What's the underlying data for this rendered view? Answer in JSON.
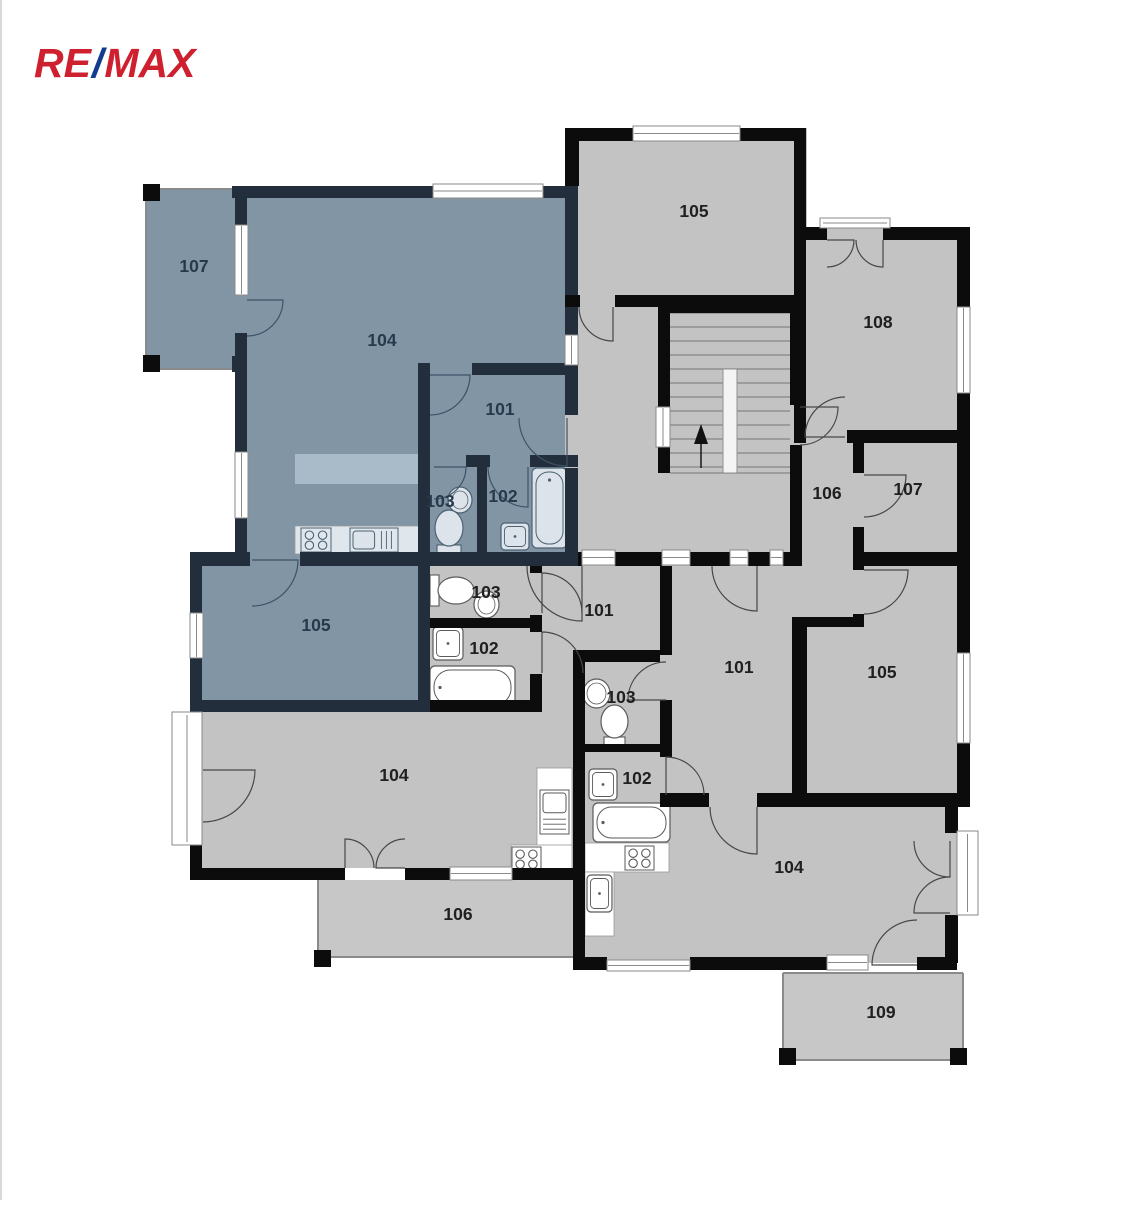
{
  "logo": {
    "re": "RE",
    "slash": "/",
    "max": "MAX",
    "red": "#cf2030",
    "blue": "#123d8f"
  },
  "palette": {
    "bg": "#ffffff",
    "room_gray": "#c3c3c3",
    "terrace_gray": "#c7c7c7",
    "room_blue": "#8195a5",
    "island_blue": "#a9bac8",
    "wall_black": "#0c0c0c",
    "wall_navy": "#222e3c",
    "label_black": "#202020",
    "label_navy": "#27394b",
    "door_black": "#474747",
    "door_navy": "#3e5368",
    "window_stroke": "#8a8a8a",
    "fixture_white": "#ffffff",
    "fixture_blue_fill": "#dce3ea",
    "fixture_blue_stroke": "#4c6172",
    "fixture_gray_stroke": "#5a5a5a",
    "stair_line": "#8f8f8f"
  },
  "floor_plan": {
    "room_labels": [
      {
        "t": "107",
        "x": 194,
        "y": 266,
        "z": "n"
      },
      {
        "t": "104",
        "x": 382,
        "y": 340,
        "z": "n"
      },
      {
        "t": "101",
        "x": 500,
        "y": 409,
        "z": "n"
      },
      {
        "t": "103",
        "x": 440,
        "y": 501,
        "z": "n"
      },
      {
        "t": "102",
        "x": 503,
        "y": 496,
        "z": "n"
      },
      {
        "t": "105",
        "x": 316,
        "y": 625,
        "z": "n"
      },
      {
        "t": "105",
        "x": 694,
        "y": 211,
        "z": "k"
      },
      {
        "t": "108",
        "x": 878,
        "y": 322,
        "z": "k"
      },
      {
        "t": "106",
        "x": 827,
        "y": 493,
        "z": "k"
      },
      {
        "t": "107",
        "x": 908,
        "y": 489,
        "z": "k"
      },
      {
        "t": "101",
        "x": 599,
        "y": 610,
        "z": "k"
      },
      {
        "t": "103",
        "x": 486,
        "y": 592,
        "z": "k"
      },
      {
        "t": "102",
        "x": 484,
        "y": 648,
        "z": "k"
      },
      {
        "t": "101",
        "x": 739,
        "y": 667,
        "z": "k"
      },
      {
        "t": "103",
        "x": 621,
        "y": 697,
        "z": "k"
      },
      {
        "t": "102",
        "x": 637,
        "y": 778,
        "z": "k"
      },
      {
        "t": "105",
        "x": 882,
        "y": 672,
        "z": "k"
      },
      {
        "t": "104",
        "x": 394,
        "y": 775,
        "z": "k"
      },
      {
        "t": "104",
        "x": 789,
        "y": 867,
        "z": "k"
      },
      {
        "t": "106",
        "x": 458,
        "y": 914,
        "z": "k"
      },
      {
        "t": "109",
        "x": 881,
        "y": 1012,
        "z": "k"
      }
    ],
    "fills": [
      [
        145,
        188,
        97,
        182,
        "b"
      ],
      [
        242,
        192,
        336,
        368,
        "b"
      ],
      [
        190,
        557,
        240,
        155,
        "b"
      ],
      [
        565,
        128,
        242,
        424,
        "g"
      ],
      [
        790,
        227,
        167,
        340,
        "g"
      ],
      [
        573,
        552,
        384,
        411,
        "g"
      ],
      [
        418,
        552,
        160,
        160,
        "g"
      ],
      [
        202,
        712,
        376,
        156,
        "g"
      ],
      [
        542,
        566,
        124,
        90,
        "g"
      ],
      [
        318,
        880,
        255,
        77,
        "t"
      ],
      [
        783,
        973,
        180,
        88,
        "t"
      ]
    ],
    "walls": [
      [
        232,
        186,
        201,
        12,
        "n"
      ],
      [
        543,
        186,
        35,
        12,
        "n"
      ],
      [
        235,
        186,
        12,
        39,
        "n"
      ],
      [
        235,
        333,
        12,
        119,
        "n"
      ],
      [
        235,
        518,
        12,
        39,
        "n"
      ],
      [
        190,
        552,
        60,
        14,
        "n"
      ],
      [
        300,
        552,
        278,
        14,
        "n"
      ],
      [
        565,
        186,
        13,
        149,
        "n"
      ],
      [
        565,
        365,
        13,
        50,
        "n"
      ],
      [
        565,
        468,
        13,
        84,
        "n"
      ],
      [
        472,
        363,
        106,
        12,
        "n"
      ],
      [
        418,
        363,
        12,
        192,
        "n"
      ],
      [
        466,
        455,
        24,
        12,
        "n"
      ],
      [
        530,
        455,
        48,
        12,
        "n"
      ],
      [
        477,
        467,
        10,
        88,
        "n"
      ],
      [
        190,
        557,
        12,
        56,
        "n"
      ],
      [
        190,
        658,
        12,
        54,
        "n"
      ],
      [
        418,
        566,
        12,
        146,
        "n"
      ],
      [
        190,
        700,
        240,
        12,
        "n"
      ],
      [
        232,
        356,
        15,
        16,
        "n"
      ],
      [
        430,
        700,
        112,
        12,
        "k"
      ],
      [
        565,
        128,
        14,
        58,
        "k"
      ],
      [
        565,
        128,
        68,
        13,
        "k"
      ],
      [
        740,
        128,
        66,
        13,
        "k"
      ],
      [
        794,
        128,
        12,
        112,
        "k"
      ],
      [
        565,
        295,
        15,
        12,
        "k"
      ],
      [
        615,
        295,
        191,
        12,
        "k"
      ],
      [
        658,
        300,
        135,
        13,
        "k"
      ],
      [
        658,
        300,
        12,
        107,
        "k"
      ],
      [
        658,
        447,
        12,
        26,
        "k"
      ],
      [
        790,
        300,
        12,
        105,
        "k"
      ],
      [
        790,
        445,
        12,
        107,
        "k"
      ],
      [
        806,
        227,
        21,
        13,
        "k"
      ],
      [
        883,
        227,
        74,
        13,
        "k"
      ],
      [
        794,
        240,
        12,
        203,
        "k"
      ],
      [
        847,
        430,
        110,
        13,
        "k"
      ],
      [
        957,
        227,
        13,
        80,
        "k"
      ],
      [
        957,
        393,
        13,
        50,
        "k"
      ],
      [
        853,
        443,
        11,
        30,
        "k"
      ],
      [
        853,
        527,
        11,
        26,
        "k"
      ],
      [
        957,
        443,
        13,
        110,
        "k"
      ],
      [
        578,
        552,
        4,
        14,
        "k"
      ],
      [
        615,
        552,
        47,
        14,
        "k"
      ],
      [
        690,
        552,
        40,
        14,
        "k"
      ],
      [
        748,
        552,
        22,
        14,
        "k"
      ],
      [
        783,
        552,
        19,
        14,
        "k"
      ],
      [
        864,
        552,
        106,
        14,
        "k"
      ],
      [
        853,
        545,
        11,
        25,
        "k"
      ],
      [
        853,
        614,
        11,
        13,
        "k"
      ],
      [
        792,
        617,
        61,
        10,
        "k"
      ],
      [
        792,
        618,
        15,
        185,
        "k"
      ],
      [
        957,
        553,
        13,
        100,
        "k"
      ],
      [
        957,
        743,
        13,
        64,
        "k"
      ],
      [
        660,
        793,
        49,
        14,
        "k"
      ],
      [
        757,
        793,
        200,
        14,
        "k"
      ],
      [
        660,
        566,
        12,
        89,
        "k"
      ],
      [
        660,
        700,
        12,
        50,
        "k"
      ],
      [
        578,
        650,
        82,
        12,
        "k"
      ],
      [
        573,
        650,
        12,
        313,
        "k"
      ],
      [
        573,
        744,
        99,
        8,
        "k"
      ],
      [
        660,
        752,
        12,
        5,
        "k"
      ],
      [
        530,
        566,
        12,
        7,
        "k"
      ],
      [
        530,
        615,
        12,
        17,
        "k"
      ],
      [
        530,
        674,
        12,
        38,
        "k"
      ],
      [
        430,
        618,
        112,
        10,
        "k"
      ],
      [
        190,
        845,
        12,
        25,
        "k"
      ],
      [
        190,
        868,
        155,
        12,
        "k"
      ],
      [
        405,
        868,
        45,
        12,
        "k"
      ],
      [
        512,
        868,
        66,
        12,
        "k"
      ],
      [
        573,
        957,
        34,
        13,
        "k"
      ],
      [
        690,
        957,
        137,
        13,
        "k"
      ],
      [
        917,
        957,
        40,
        13,
        "k"
      ],
      [
        945,
        807,
        13,
        26,
        "k"
      ],
      [
        945,
        915,
        13,
        48,
        "k"
      ]
    ],
    "corner_squares": [
      [
        143,
        184,
        17,
        17
      ],
      [
        143,
        355,
        17,
        17
      ],
      [
        314,
        950,
        17,
        17
      ],
      [
        779,
        1048,
        17,
        17
      ],
      [
        950,
        1048,
        17,
        17
      ]
    ],
    "windows": [
      [
        433,
        184,
        110,
        14,
        "h"
      ],
      [
        633,
        126,
        107,
        15,
        "h"
      ],
      [
        235,
        225,
        13,
        70,
        "v"
      ],
      [
        235,
        452,
        13,
        66,
        "v"
      ],
      [
        957,
        307,
        13,
        86,
        "v"
      ],
      [
        957,
        653,
        13,
        90,
        "v"
      ],
      [
        190,
        613,
        13,
        45,
        "v"
      ],
      [
        172,
        712,
        30,
        133,
        "f"
      ],
      [
        450,
        867,
        62,
        13,
        "h"
      ],
      [
        582,
        550,
        33,
        15,
        "h"
      ],
      [
        662,
        550,
        28,
        15,
        "h"
      ],
      [
        730,
        550,
        18,
        15,
        "h"
      ],
      [
        770,
        550,
        13,
        15,
        "h"
      ],
      [
        565,
        335,
        13,
        30,
        "v"
      ],
      [
        656,
        407,
        14,
        40,
        "v"
      ],
      [
        827,
        955,
        41,
        15,
        "h"
      ],
      [
        957,
        831,
        21,
        84,
        "f"
      ],
      [
        820,
        218,
        70,
        10,
        "f"
      ],
      [
        607,
        960,
        83,
        11,
        "h"
      ]
    ],
    "terrace_outlines": [
      {
        "segs": [
          [
            146,
            189,
            239,
            189
          ],
          [
            146,
            189,
            146,
            369
          ],
          [
            146,
            369,
            239,
            369
          ]
        ]
      },
      {
        "segs": [
          [
            318,
            880,
            318,
            957
          ],
          [
            318,
            957,
            573,
            957
          ]
        ]
      },
      {
        "segs": [
          [
            783,
            973,
            963,
            973
          ],
          [
            783,
            973,
            783,
            1060
          ],
          [
            963,
            973,
            963,
            1060
          ],
          [
            783,
            1060,
            963,
            1060
          ]
        ]
      }
    ],
    "doors": [
      [
        247,
        300,
        36,
        0,
        90,
        "n"
      ],
      [
        430,
        375,
        40,
        0,
        90,
        "n"
      ],
      [
        567,
        418,
        48,
        90,
        180,
        "n"
      ],
      [
        434,
        467,
        32,
        0,
        90,
        "n"
      ],
      [
        528,
        467,
        40,
        90,
        180,
        "n"
      ],
      [
        252,
        560,
        46,
        0,
        90,
        "n"
      ],
      [
        613,
        307,
        34,
        90,
        180,
        "k"
      ],
      [
        800,
        407,
        38,
        0,
        90,
        "k"
      ],
      [
        845,
        437,
        40,
        180,
        270,
        "k"
      ],
      [
        864,
        475,
        42,
        0,
        90,
        "k"
      ],
      [
        864,
        570,
        44,
        0,
        90,
        "k"
      ],
      [
        757,
        566,
        45,
        90,
        180,
        "k"
      ],
      [
        582,
        566,
        55,
        90,
        180,
        "k"
      ],
      [
        542,
        613,
        40,
        270,
        360,
        "k"
      ],
      [
        542,
        673,
        41,
        270,
        360,
        "k"
      ],
      [
        666,
        700,
        38,
        180,
        270,
        "k"
      ],
      [
        666,
        795,
        38,
        270,
        360,
        "k"
      ],
      [
        757,
        807,
        47,
        90,
        180,
        "k"
      ],
      [
        345,
        868,
        29,
        270,
        360,
        "k"
      ],
      [
        405,
        868,
        29,
        180,
        270,
        "k"
      ],
      [
        203,
        770,
        52,
        0,
        90,
        "k"
      ],
      [
        917,
        965,
        45,
        180,
        270,
        "k"
      ],
      [
        950,
        841,
        36,
        90,
        180,
        "k"
      ],
      [
        950,
        913,
        36,
        180,
        270,
        "k"
      ],
      [
        827,
        240,
        27,
        0,
        90,
        "k"
      ],
      [
        883,
        240,
        27,
        90,
        180,
        "k"
      ]
    ],
    "stairs": {
      "area": [
        670,
        313,
        120,
        160
      ],
      "treads_full_y": [
        313,
        327,
        341,
        355,
        369
      ],
      "treads_split_y": [
        383,
        397,
        411,
        425,
        439,
        453,
        467
      ],
      "split_x": [
        670,
        723,
        737,
        790
      ],
      "stringer": [
        723,
        369,
        14,
        104
      ],
      "arrow": {
        "line": [
          701,
          468,
          701,
          442
        ],
        "tri": [
          [
            701,
            424
          ],
          [
            694,
            444
          ],
          [
            708,
            444
          ]
        ]
      }
    },
    "fixtures": [
      {
        "type": "island",
        "r": [
          295,
          454,
          126,
          30
        ]
      },
      {
        "type": "counter",
        "z": "n",
        "r": [
          295,
          526,
          126,
          28
        ]
      },
      {
        "type": "stove",
        "z": "n",
        "r": [
          301,
          528,
          30,
          24
        ]
      },
      {
        "type": "sink-unit",
        "z": "n",
        "r": [
          350,
          528,
          48,
          24
        ]
      },
      {
        "type": "sink-round",
        "z": "n",
        "e": [
          448,
          487,
          24,
          26
        ]
      },
      {
        "type": "toilet",
        "z": "n",
        "bowl": [
          435,
          510,
          28,
          36
        ],
        "tank": [
          437,
          545,
          24,
          8
        ]
      },
      {
        "type": "sink-rect",
        "z": "n",
        "r": [
          501,
          523,
          28,
          27
        ]
      },
      {
        "type": "tub",
        "z": "n",
        "r": [
          532,
          468,
          35,
          80
        ]
      },
      {
        "type": "toilet",
        "z": "k",
        "bowl": [
          438,
          577,
          36,
          27
        ],
        "tank": [
          430,
          575,
          9,
          31
        ]
      },
      {
        "type": "sink-round",
        "z": "k",
        "e": [
          474,
          591,
          25,
          27
        ]
      },
      {
        "type": "sink-rect",
        "z": "k",
        "r": [
          433,
          627,
          30,
          33
        ]
      },
      {
        "type": "tub",
        "z": "k",
        "r": [
          430,
          666,
          85,
          43
        ]
      },
      {
        "type": "counter",
        "z": "k",
        "r": [
          537,
          768,
          35,
          80
        ]
      },
      {
        "type": "counter",
        "z": "k",
        "r": [
          511,
          845,
          61,
          28
        ]
      },
      {
        "type": "sink-unit",
        "z": "k",
        "r": [
          540,
          790,
          29,
          44
        ]
      },
      {
        "type": "stove",
        "z": "k",
        "r": [
          512,
          847,
          29,
          24
        ]
      },
      {
        "type": "sink-round",
        "z": "k",
        "e": [
          583,
          679,
          27,
          29
        ]
      },
      {
        "type": "toilet",
        "z": "k",
        "bowl": [
          601,
          705,
          27,
          33
        ],
        "tank": [
          604,
          737,
          21,
          8
        ]
      },
      {
        "type": "sink-rect",
        "z": "k",
        "r": [
          589,
          769,
          28,
          31
        ]
      },
      {
        "type": "tub",
        "z": "k",
        "r": [
          593,
          803,
          77,
          39
        ]
      },
      {
        "type": "counter",
        "z": "k",
        "r": [
          585,
          843,
          84,
          29
        ]
      },
      {
        "type": "counter",
        "z": "k",
        "r": [
          585,
          872,
          29,
          64
        ]
      },
      {
        "type": "stove",
        "z": "k",
        "r": [
          625,
          846,
          29,
          24
        ]
      },
      {
        "type": "sink-rect",
        "z": "k",
        "r": [
          587,
          875,
          25,
          37
        ]
      }
    ]
  }
}
